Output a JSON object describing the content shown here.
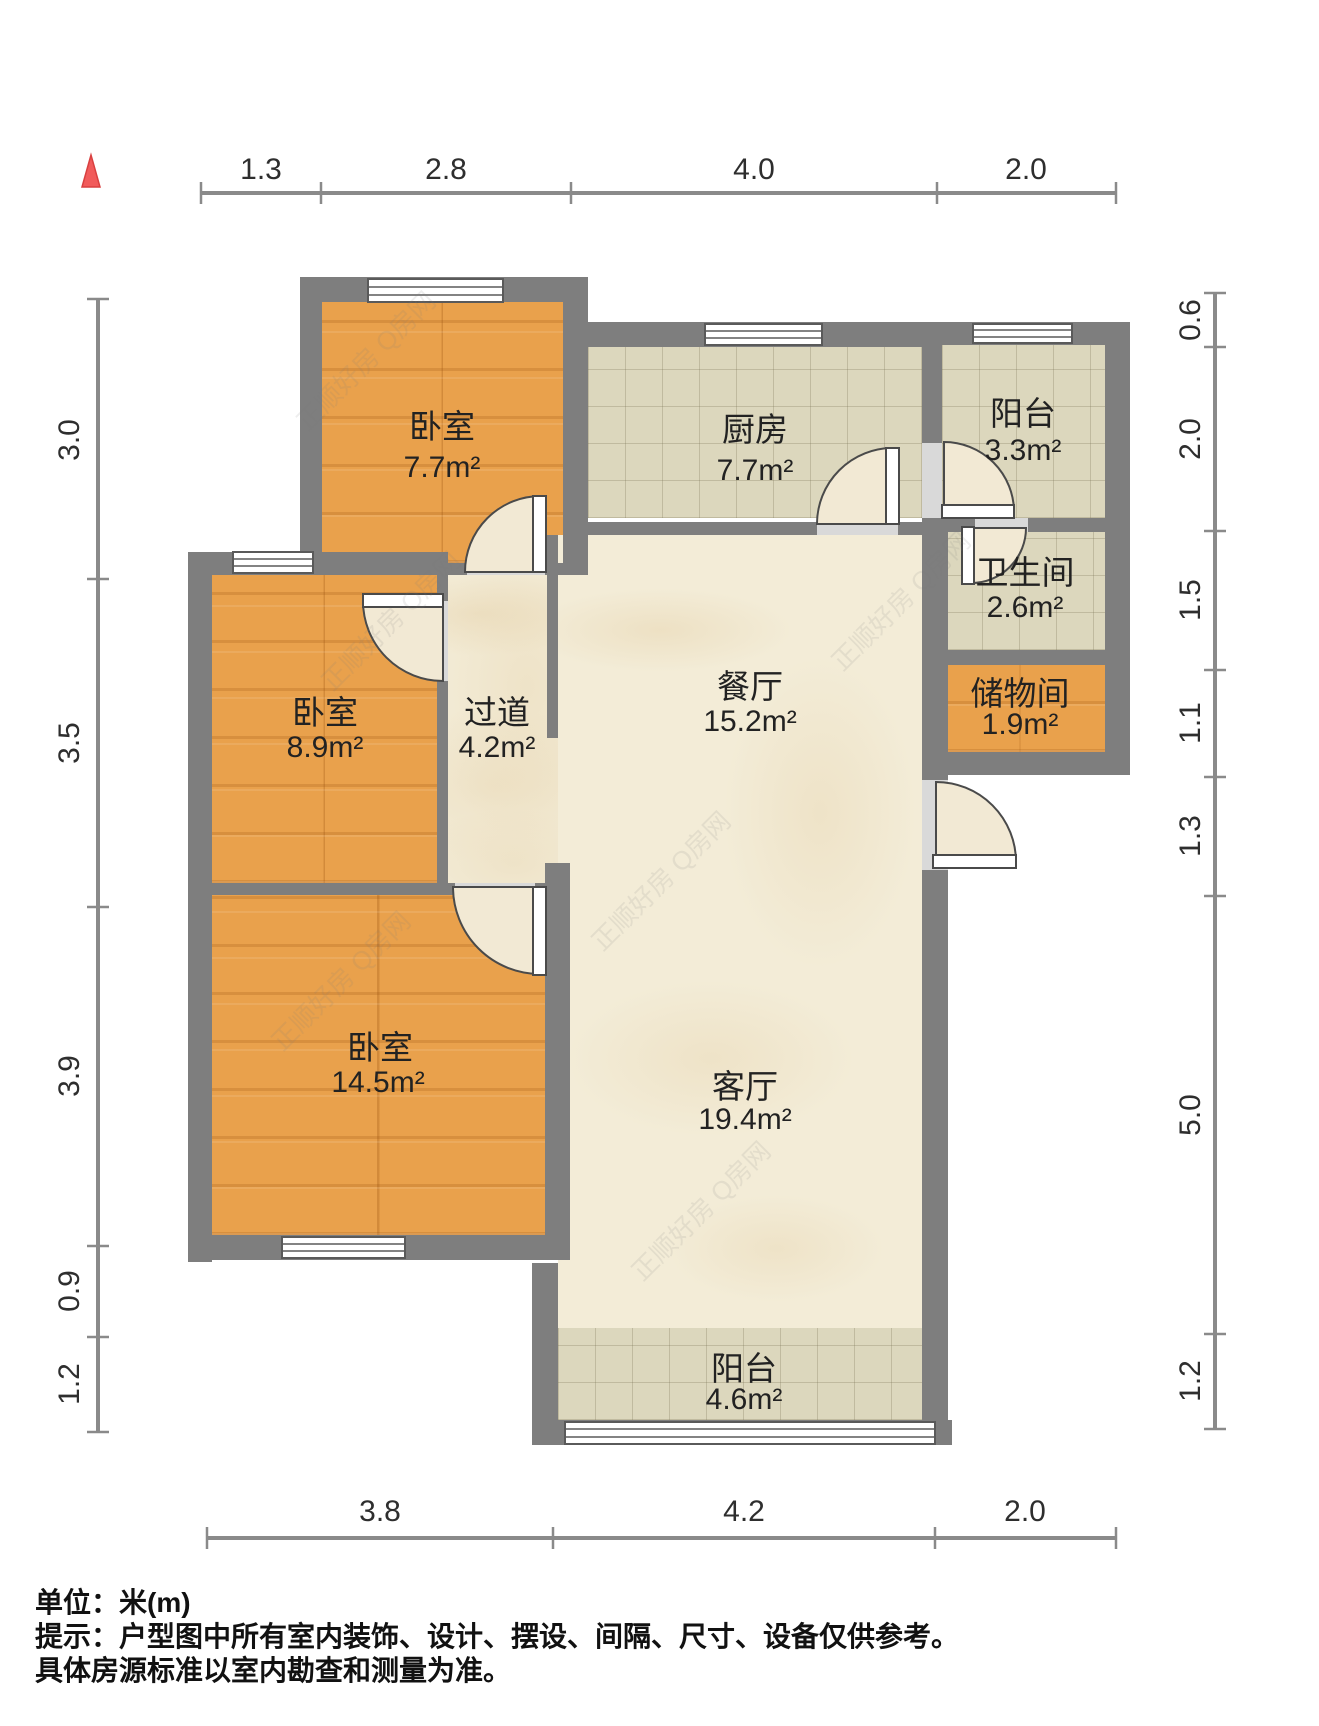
{
  "title": "户型图",
  "compass": {
    "icon": "north-triangle",
    "color": "#f15b5b"
  },
  "colors": {
    "wall": "#7e7e7e",
    "wood_floor": "#e9a14c",
    "tile_floor": "#dcd7bd",
    "marble_floor": "#f3ecd7",
    "dimension_line": "#8a8a8a"
  },
  "dimensions": {
    "top": [
      "1.3",
      "2.8",
      "4.0",
      "2.0"
    ],
    "bottom": [
      "3.8",
      "4.2",
      "2.0"
    ],
    "left": [
      "3.0",
      "3.5",
      "3.9",
      "0.9",
      "1.2"
    ],
    "right": [
      "0.6",
      "2.0",
      "1.5",
      "1.1",
      "1.3",
      "5.0",
      "1.2"
    ]
  },
  "rooms": [
    {
      "name": "卧室",
      "area": "7.7m²"
    },
    {
      "name": "厨房",
      "area": "7.7m²"
    },
    {
      "name": "阳台",
      "area": "3.3m²"
    },
    {
      "name": "卫生间",
      "area": "2.6m²"
    },
    {
      "name": "储物间",
      "area": "1.9m²"
    },
    {
      "name": "卧室",
      "area": "8.9m²"
    },
    {
      "name": "过道",
      "area": "4.2m²"
    },
    {
      "name": "餐厅",
      "area": "15.2m²"
    },
    {
      "name": "卧室",
      "area": "14.5m²"
    },
    {
      "name": "客厅",
      "area": "19.4m²"
    },
    {
      "name": "阳台",
      "area": "4.6m²"
    }
  ],
  "footer": {
    "line1": "单位：米(m)",
    "line2": "提示：户型图中所有室内装饰、设计、摆设、间隔、尺寸、设备仅供参考。",
    "line3": "具体房源标准以室内勘查和测量为准。"
  },
  "watermark": "正顺好房 Q房网"
}
